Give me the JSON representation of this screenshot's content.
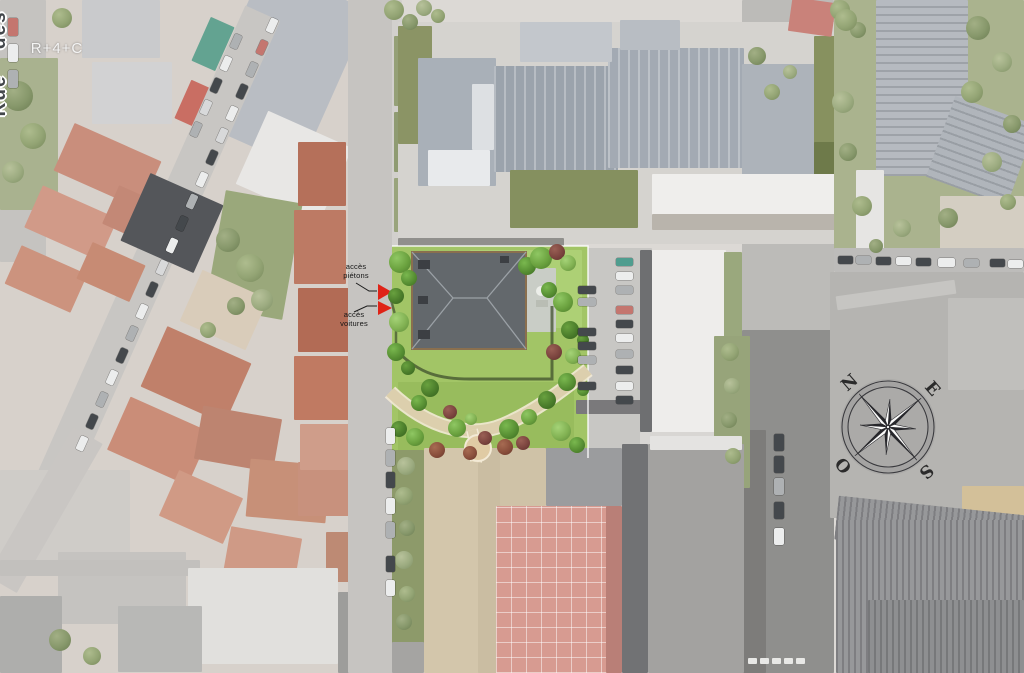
{
  "site": {
    "building_label": "R+4+C",
    "access_labels": [
      {
        "label": "accès piétons"
      },
      {
        "label": "accès voitures"
      }
    ]
  },
  "streets": {
    "main": "Rue des Pavillons"
  },
  "compass": {
    "north": "N",
    "east": "E",
    "south": "S",
    "west": "O"
  },
  "palette": {
    "site_lawn_green": "#a2c566",
    "project_roof_gray": "#63686c",
    "access_arrow_red": "#df2317",
    "render_roof_gray": "#a3aab3",
    "olive_flat_roof": "#85905f",
    "terracotta_roof": "#c98e7c",
    "garden_path_beige": "#dcceac",
    "street_gray": "#c6c4c1"
  }
}
